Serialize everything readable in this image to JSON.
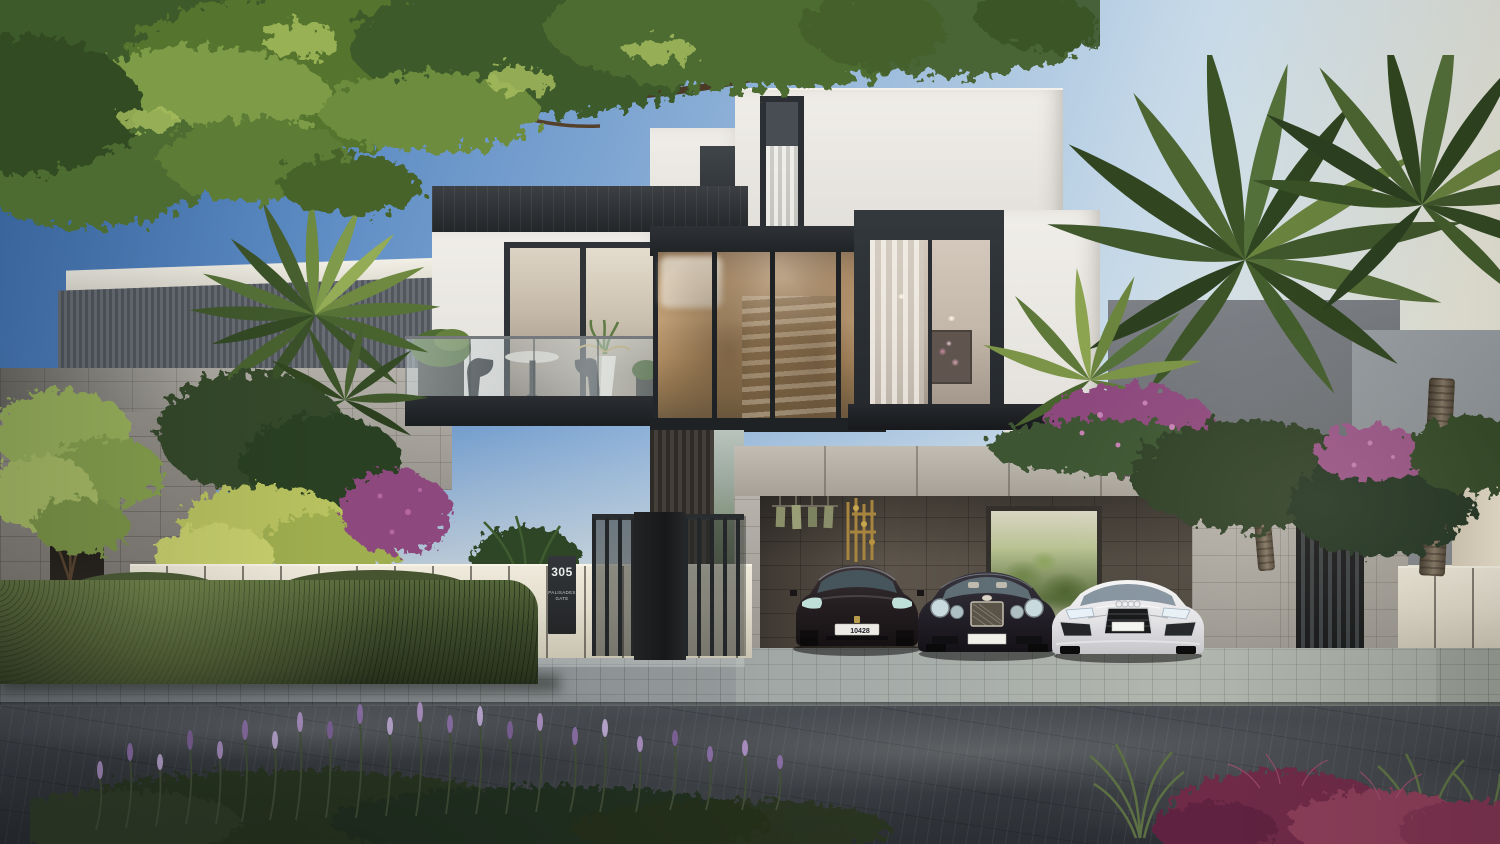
{
  "scene": {
    "description": "Daytime photorealistic exterior rendering of a modern three-storey villa: white stone upper volumes with dark window frames, a double-height amber glass atrium with an interior staircase, a stone entry court, a covered three-car garage, a cream boundary fence with a clipped hedge, palm trees and an overhanging tree canopy, and a dark paved street in the foreground",
    "style": "architectural visualization",
    "lighting": "clear day, warm light from the right"
  },
  "signage": {
    "house_number": "305",
    "community_line1": "PALISADES",
    "community_line2": "GATE"
  },
  "vehicles": [
    {
      "position": "left",
      "body": "dark bronze luxury sedan",
      "plate": "10428"
    },
    {
      "position": "middle",
      "body": "dark grand tourer coupe",
      "plate": ""
    },
    {
      "position": "right",
      "body": "white sports coupe",
      "plate": ""
    }
  ],
  "landscape": {
    "hedge": "clipped green hedge along street wall",
    "foreground_plants": [
      "purple flowering shrub",
      "burgundy fountain grass",
      "green grasses"
    ],
    "trees": [
      "overhanging canopy top-left",
      "left garden palm",
      "three right palms",
      "bougainvillea"
    ]
  },
  "palette": {
    "sky_top": "#3c70b4",
    "sky_horizon": "#f3ecd8",
    "villa_white": "#ebe8e2",
    "frame_dark": "#2c3034",
    "stone_light": "#b4afa6",
    "stone_mid": "#8f8a83",
    "warm_glass": "#c29c6e",
    "hedge_green": "#42512e",
    "palm_green": "#4c6134",
    "bougainvillea": "#8d4a7d",
    "road": "#3a3e43",
    "fence_cream": "#e7e2d4"
  }
}
